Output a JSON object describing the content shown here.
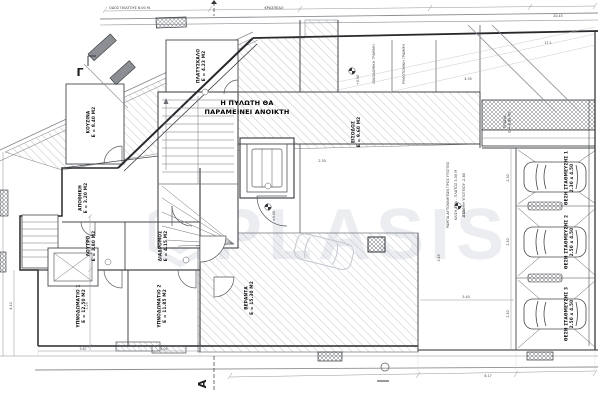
{
  "watermark": {
    "text": "PLASIS",
    "logo": "hexagon"
  },
  "note": {
    "line1": "Η ΠΥΛΩΤΗ ΘΑ",
    "line2": "ΠΑΡΑΜΕΙΝΕΙ ΑΝΟΙΚΤΗ"
  },
  "markers": {
    "gamma": "Γ",
    "alpha": "Α"
  },
  "streets": {
    "top1": "ΟΔΟΣ ΠΛΑΤΟΥΣ 8.00 Μ.",
    "top2": "ΚΡΑΣΠΕΔΟ",
    "building_line": "ΟΙΚΟΔΟΜΙΚΗ ΓΡΑΜΜΗ",
    "street_line": "ΡΥΜΟΤΟΜΙΚΗ ΓΡΑΜΜΗ"
  },
  "rooms": [
    {
      "name": "ΚΟΥΖΙΝΑ",
      "area": "Ε = 8.40 Μ2"
    },
    {
      "name": "ΠΛΑΤΥΣΚΑΛΟ",
      "area": "Ε = 4.23 Μ2"
    },
    {
      "name": "ΕΙΣΟΔΟΣ",
      "area": "Ε = 9.60 Μ2"
    },
    {
      "name": "ΥΠΝΟΔΩΜΑΤΙΟ 1",
      "area": "Ε = 12.50 Μ2"
    },
    {
      "name": "ΥΠΝΟΔΩΜΑΤΙΟ 2",
      "area": "Ε = 11.85 Μ2"
    },
    {
      "name": "ΒΕΡΑΝΤΑ",
      "area": "Ε = 15.30 Μ2"
    },
    {
      "name": "ΛΟΥΤΡΟ",
      "area": "Ε = 3.80 Μ2"
    },
    {
      "name": "ΔΙΑΔΡΟΜΟΣ",
      "area": "Ε = 4.15 Μ2"
    },
    {
      "name": "ΑΠΟΘΗΚΗ",
      "area": "Ε = 3.20 Μ2"
    },
    {
      "name": "ΠΡΑΣΙΑ",
      "area": "Ε = 8.90 Μ2"
    }
  ],
  "parking": {
    "stalls": [
      {
        "label": "ΘΕΣΗ ΣΤΑΘΜΕΥΣΗΣ 1",
        "size": "2.30 x 4.50"
      },
      {
        "label": "ΘΕΣΗ ΣΤΑΘΜΕΥΣΗΣ 2",
        "size": "2.50 x 4.50"
      },
      {
        "label": "ΘΕΣΗ ΣΤΑΘΜΕΥΣΗΣ 3",
        "size": "2.50 x 4.50"
      }
    ]
  },
  "ramp_notes": [
    "ΡΑΜΠΑ ΑΥΤΟΚΙΝΗΤΩΝ ΠΡΟΣ ΥΠΟΓΕΙΟ",
    "ΚΛΙΣΗ 18% - ΠΛΑΤΟΣ 3.00 Μ",
    "ΣΤΑΘΜΗ ΥΠΟΓΕΙΟΥ -2.80"
  ],
  "levels": {
    "l1": "+0.90",
    "l2": "±0.00",
    "l3": "-0.02"
  },
  "dimensions": {
    "top": [
      "20.45"
    ],
    "right": [
      "2.30",
      "2.50",
      "2.50"
    ],
    "left": [
      "2.90",
      "3.25",
      "4.10"
    ],
    "bottom": [
      "3.67",
      "3.05",
      "8.17"
    ],
    "misc": [
      "17.1",
      "4.35",
      "5.40",
      "3.45",
      "2.30"
    ]
  }
}
